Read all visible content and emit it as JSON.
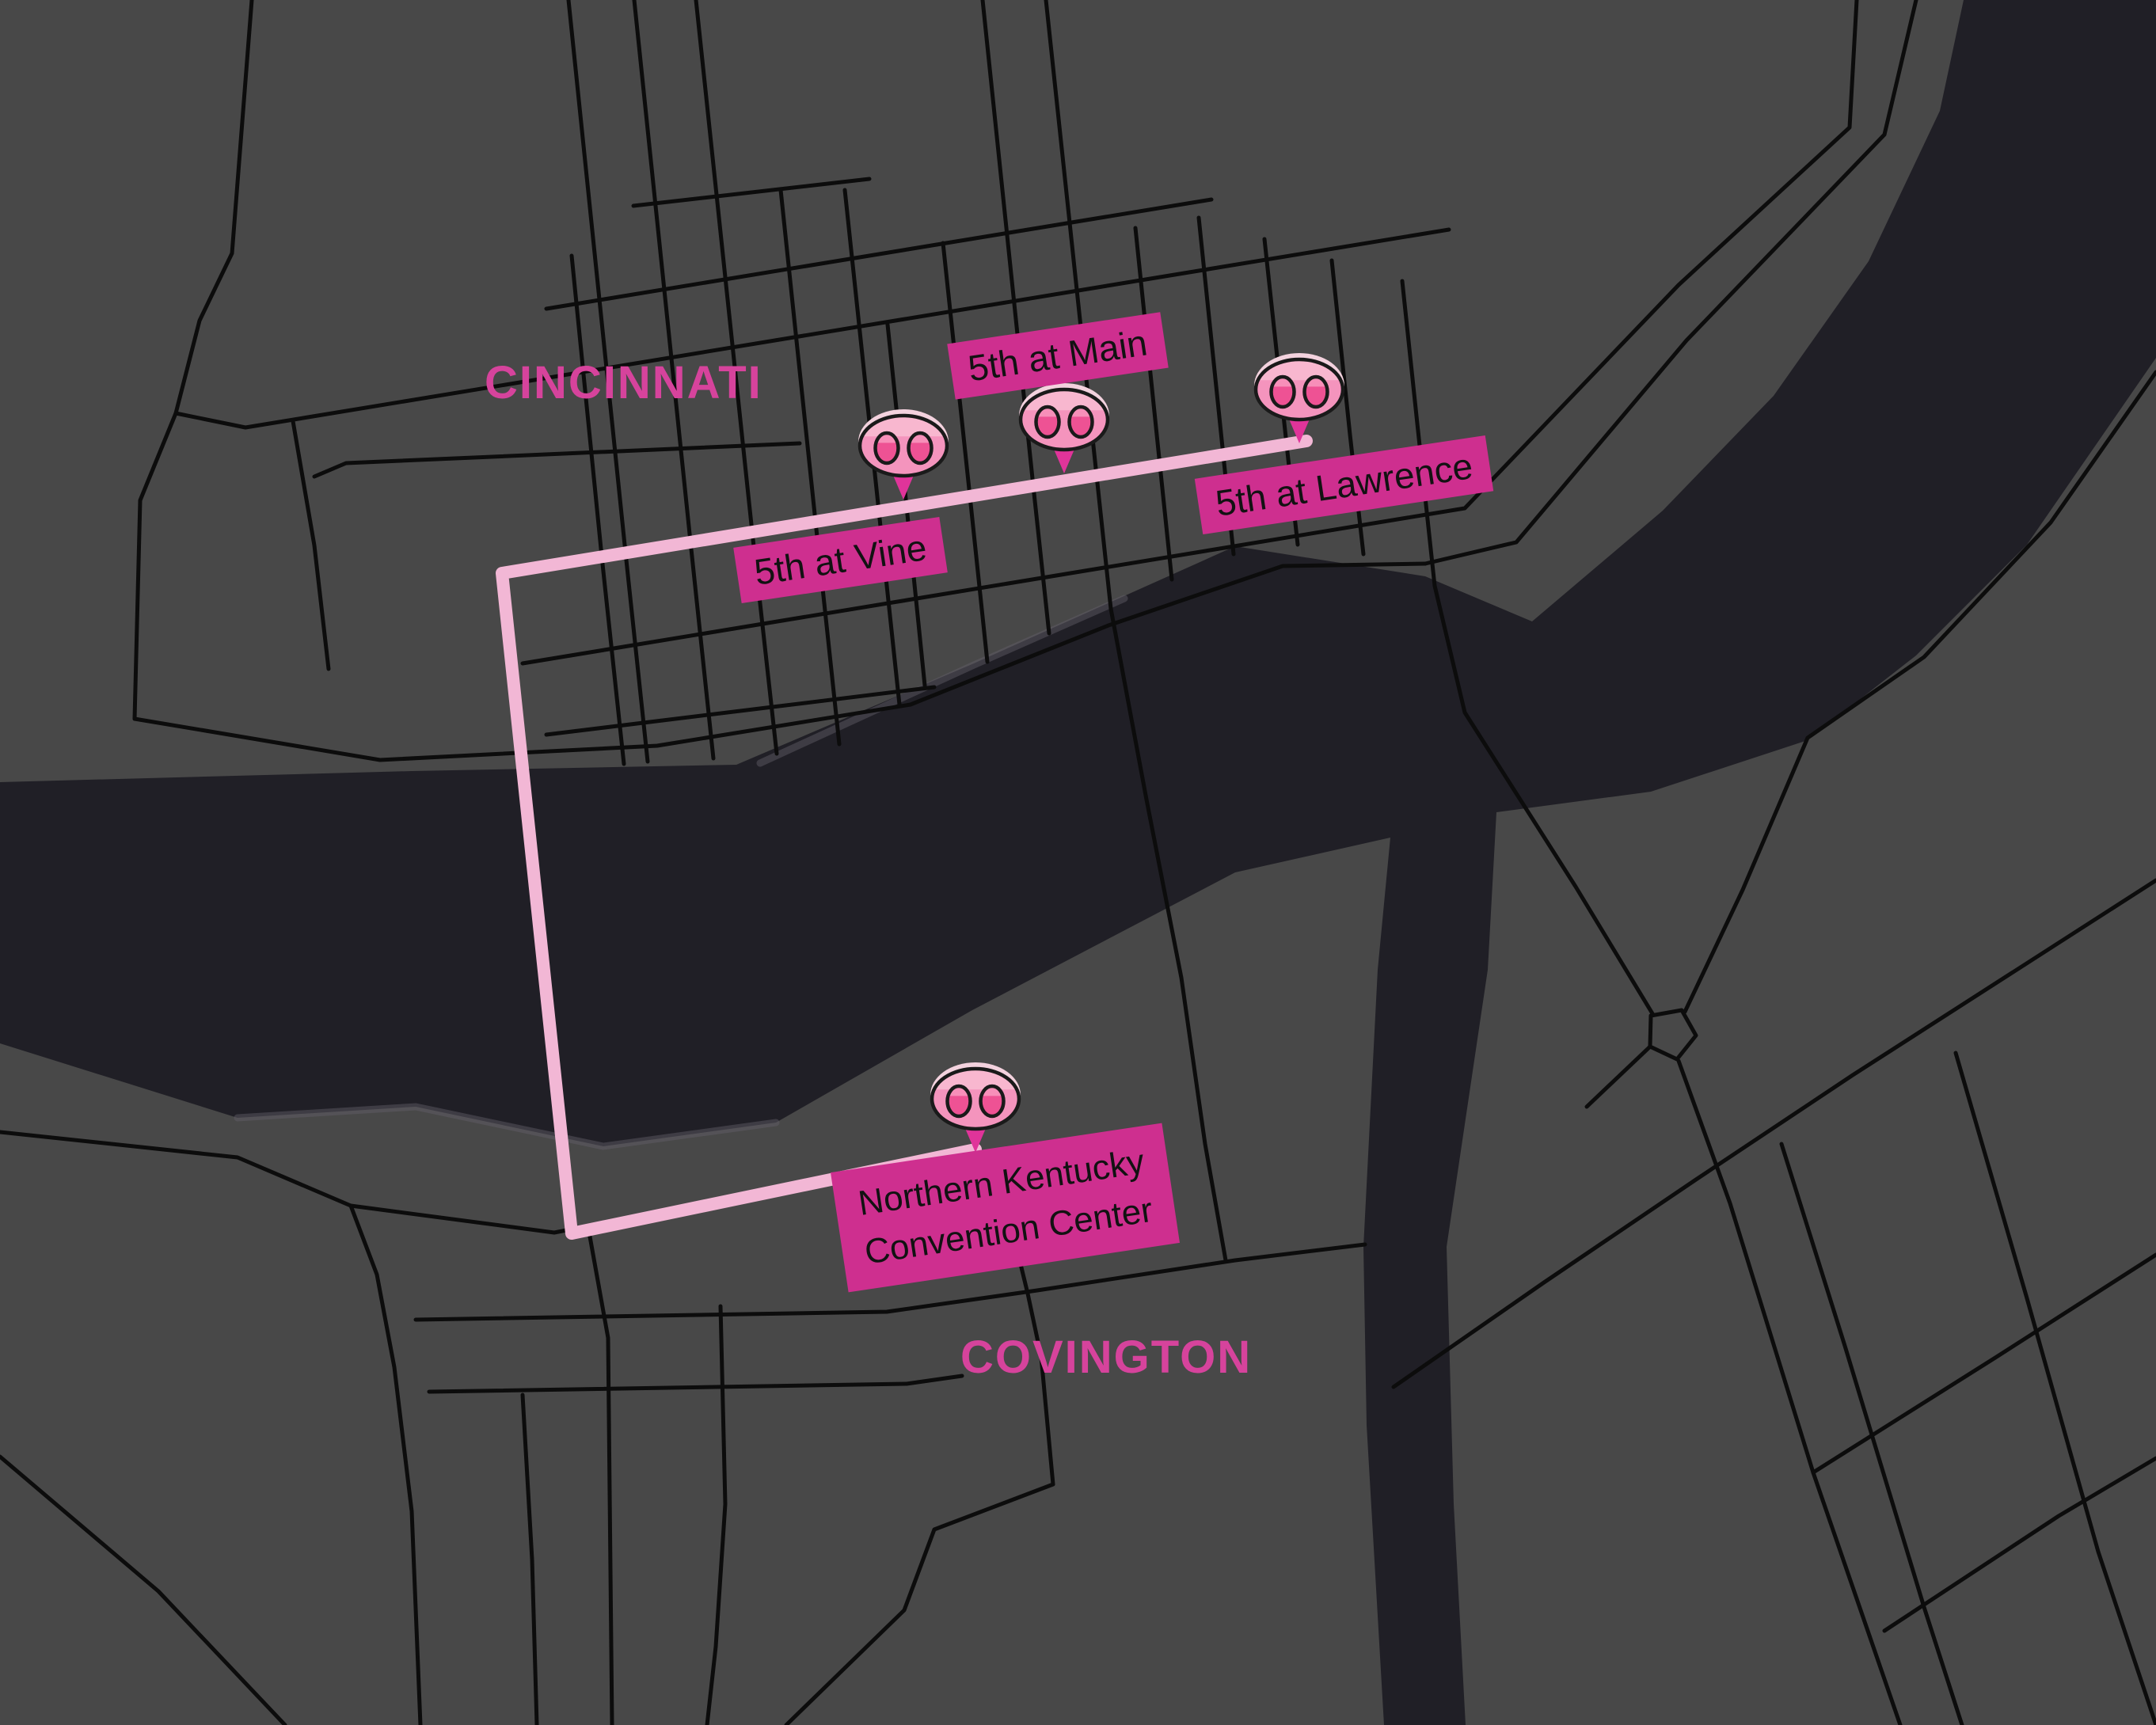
{
  "map": {
    "regions": [
      {
        "name": "CINCINNATI"
      },
      {
        "name": "COVINGTON"
      }
    ],
    "stops": [
      {
        "id": "vine",
        "label": "5th at Vine"
      },
      {
        "id": "main",
        "label": "5th at Main"
      },
      {
        "id": "lawrence",
        "label": "5th at Lawrence"
      },
      {
        "id": "nkcc",
        "label": "Northern Kentucky Convention Center",
        "lines": [
          "Northern Kentucky",
          "Convention Center"
        ]
      }
    ],
    "marker_icon": "pig-nose-marker",
    "theme": {
      "land": "#484848",
      "river": "#201f26",
      "road": "#0c0c0c",
      "route": "#f2b7d5",
      "label-bg": "#ce2f8f",
      "label-text": "#121212",
      "city-text": "#d6439c",
      "marker-body": "#f494bd",
      "marker-body-light": "#f8b7cf",
      "marker-nostril": "#ee5294",
      "marker-nostril-light": "#f78fb9",
      "marker-pointer": "#e0349a",
      "marker-outline": "#1a1a1a",
      "marker-rim": "#f3d2de"
    }
  }
}
